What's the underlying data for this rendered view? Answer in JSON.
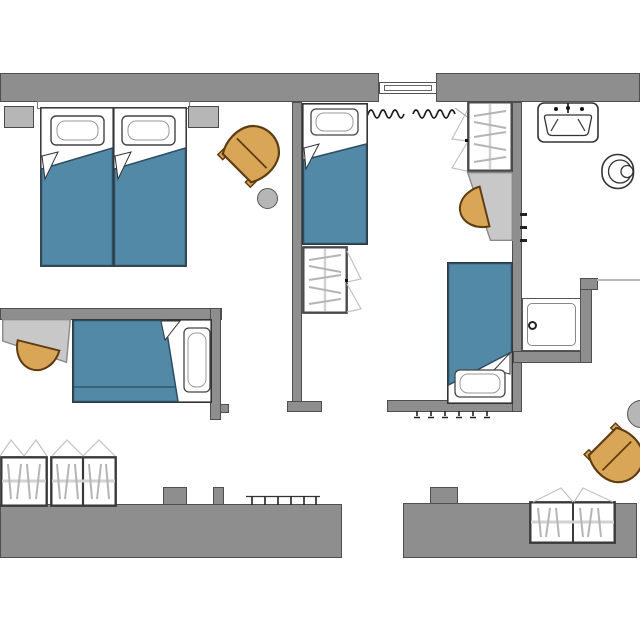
{
  "meta": {
    "type": "floor-plan",
    "description": "Top-view architectural floor plan of an apartment with three bedrooms, a bathroom, a hallway and a lounge corner. No text labels are rendered on the plan."
  },
  "palette": {
    "wall": "#8e8e8e",
    "wall_outline": "#4f4f4f",
    "furniture_gray": "#b6b6b6",
    "desk_gray": "#c8c8c8",
    "desk_outline": "#8a8a8a",
    "blanket_blue": "#5289a7",
    "blanket_outline": "#2e4d63",
    "chair_orange": "#d9a557",
    "chair_outline": "#5e3c12",
    "bed_outline": "#333333",
    "hanger_gray": "#b5b5b5",
    "swing_gray": "#c2c2c2",
    "fixture_outline": "#333333",
    "curtain_black": "#1a1a1a"
  },
  "rooms": {
    "bedroom_left": {
      "label": "bedroom-left",
      "furniture": [
        "double bed (two singles with blue duvets)",
        "headboard",
        "nightstand left",
        "nightstand right",
        "tub armchair",
        "round side table"
      ]
    },
    "bedroom_middle": {
      "label": "bedroom-middle",
      "furniture": [
        "single bed top",
        "single bed bottom",
        "closet with hangers",
        "wardrobe with hangers",
        "desk",
        "half-round desk chair",
        "double window with curtains",
        "radiator"
      ]
    },
    "bathroom": {
      "label": "bathroom",
      "furniture": [
        "washbasin",
        "toilet",
        "shower tray with drain",
        "glass partition",
        "wall hooks"
      ]
    },
    "bedroom_bottom_left": {
      "label": "bedroom-bottom-left",
      "furniture": [
        "bed with blue duvet",
        "desk",
        "half-round desk chair",
        "wardrobe unit 1",
        "wardrobe unit 2",
        "radiator"
      ]
    },
    "lounge_bottom_right": {
      "label": "lounge-bottom-right",
      "furniture": [
        "tub armchair",
        "round side table",
        "built-in wardrobe"
      ]
    }
  }
}
